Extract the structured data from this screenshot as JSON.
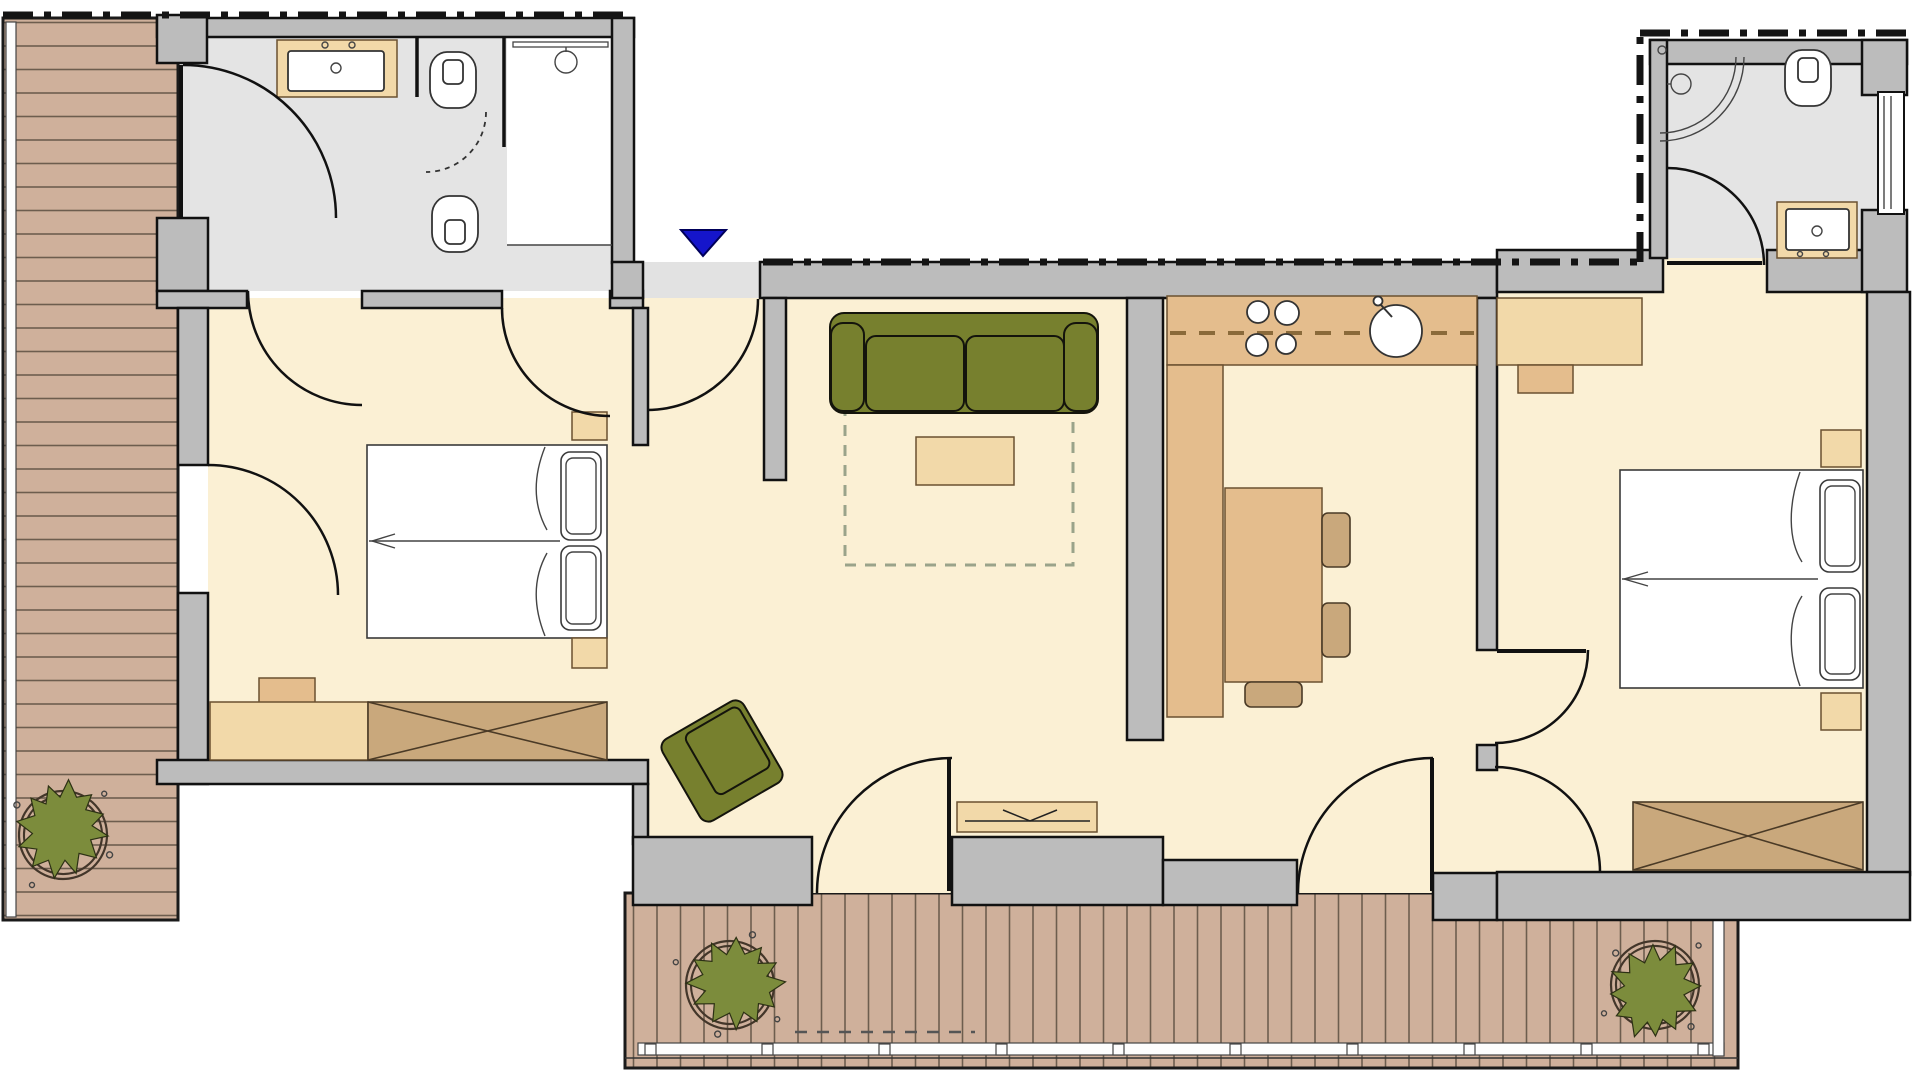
{
  "meta": {
    "document_type": "architectural floor plan",
    "canvas_width_px": 1920,
    "canvas_height_px": 1080,
    "visible_text": "none"
  },
  "colors": {
    "wall_gray": "#bcbcbc",
    "floor_cream": "#fbf0d4",
    "floor_bath": "#e4e4e4",
    "floor_hall": "#e2e2e2",
    "deck_wood": "#cfb09b",
    "deck_line": "#6d5d4e",
    "furniture_tan_light": "#f2d9a9",
    "furniture_tan_mid": "#e4bd8d",
    "furniture_tan_dark": "#c9a87c",
    "sofa_olive": "#77802e",
    "plant_green": "#7c8c3c",
    "entrance_blue": "#1515cb",
    "outline_black": "#111111",
    "fixture_white": "#ffffff"
  },
  "markers": {
    "entrance": {
      "symbol": "filled triangle pointing down",
      "color": "#1515cb",
      "meaning": "main entrance"
    },
    "property_line": {
      "style": "black dash-dot line along top boundary"
    }
  },
  "rooms": [
    {
      "name": "bathroom-top-left",
      "floor": "light gray",
      "fixtures": [
        "vanity with washbasin",
        "toilet",
        "toilet",
        "shower with rail and head",
        "swing screen (dashed arc)"
      ]
    },
    {
      "name": "bedroom-left",
      "floor": "cream",
      "furniture": [
        "double bed with two pillows",
        "nightstand",
        "nightstand",
        "dresser",
        "bench",
        "wardrobe with X symbol"
      ],
      "doors": [
        "to corridor (2)",
        "to left deck"
      ]
    },
    {
      "name": "entry-hall",
      "floor": "light gray",
      "doors": [
        "entrance door at top"
      ]
    },
    {
      "name": "living-room",
      "floor": "cream",
      "furniture": [
        "olive two-seat sofa",
        "dashed rug outline",
        "coffee table",
        "olive armchair (rotated)",
        "tv sideboard"
      ],
      "doors": [
        "balcony door to south deck"
      ]
    },
    {
      "name": "kitchen",
      "floor": "cream",
      "furniture": [
        "counter with 4-burner cooktop",
        "round sink with faucet",
        "side counter",
        "dining table",
        "chair",
        "chair",
        "chair"
      ],
      "doors": [
        "balcony door to south deck"
      ]
    },
    {
      "name": "bedroom-right",
      "floor": "cream",
      "furniture": [
        "desk",
        "chair",
        "double bed with two pillows",
        "nightstand",
        "nightstand",
        "wardrobe with X symbol"
      ],
      "doors": [
        "from hallway (2)",
        "to bathroom-top-right"
      ]
    },
    {
      "name": "bathroom-top-right",
      "floor": "light gray",
      "fixtures": [
        "corner shower (quarter-circle)",
        "shower head",
        "toilet",
        "vanity with washbasin",
        "window in right wall"
      ]
    },
    {
      "name": "deck-left",
      "type": "wooden terrace, horizontal planks",
      "items": [
        "potted plant"
      ]
    },
    {
      "name": "deck-south",
      "type": "wooden terrace, vertical planks with railing",
      "items": [
        "potted plant left",
        "potted plant right",
        "dashed marking"
      ]
    }
  ]
}
